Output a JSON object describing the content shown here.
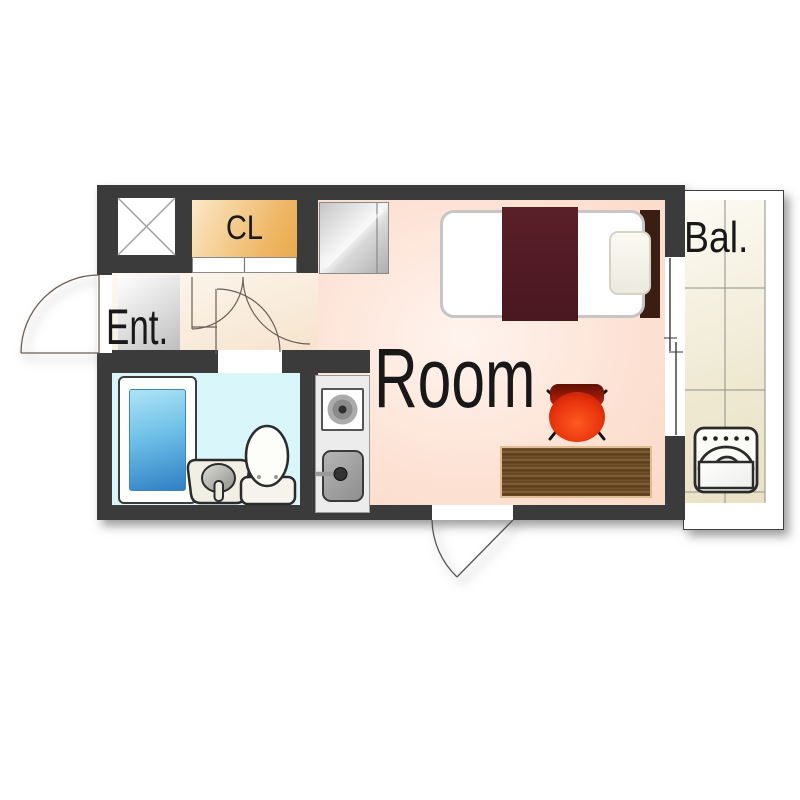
{
  "floorplan": {
    "title": "one-room apartment floor plan",
    "rooms": {
      "entrance": {
        "label": "Ent."
      },
      "closet": {
        "label": "CL"
      },
      "main_room": {
        "label": "Room"
      },
      "balcony": {
        "label": "Bal."
      }
    },
    "fixtures": [
      "shaft-x-box-icon",
      "refrigerator-icon",
      "bed-icon",
      "pillow-icon",
      "blanket-icon",
      "chair-icon",
      "low-table-icon",
      "kitchen-stove-icon",
      "kitchen-sink-icon",
      "bathtub-icon",
      "washbasin-icon",
      "toilet-icon",
      "washing-machine-icon",
      "entrance-door-icon",
      "bathroom-door-icon",
      "room-door-icon",
      "closet-sliding-door-icon",
      "balcony-sliding-window-icon",
      "south-door-icon"
    ],
    "colors": {
      "wall": "#3b3b3b",
      "room_floor": "#fbd9c6",
      "room_floor_light": "#fff4ee",
      "closet_orange": "#eeb562",
      "closet_orange_light": "#fce8c8",
      "entrance_gray": "#bcbcbc",
      "hall_floor": "#f6e3cc",
      "bathroom_cyan": "#d9f6fa",
      "balcony_tile": "#e9e2c6",
      "balcony_tile_light": "#fcfaf3",
      "water_blue": "#2f7fc4",
      "bed_blanket": "#4a1620",
      "bed_headboard": "#3a1e12",
      "chair_red": "#d62305",
      "table_wood": "#6e4c28",
      "outline_dark": "#2b2b2b"
    }
  }
}
